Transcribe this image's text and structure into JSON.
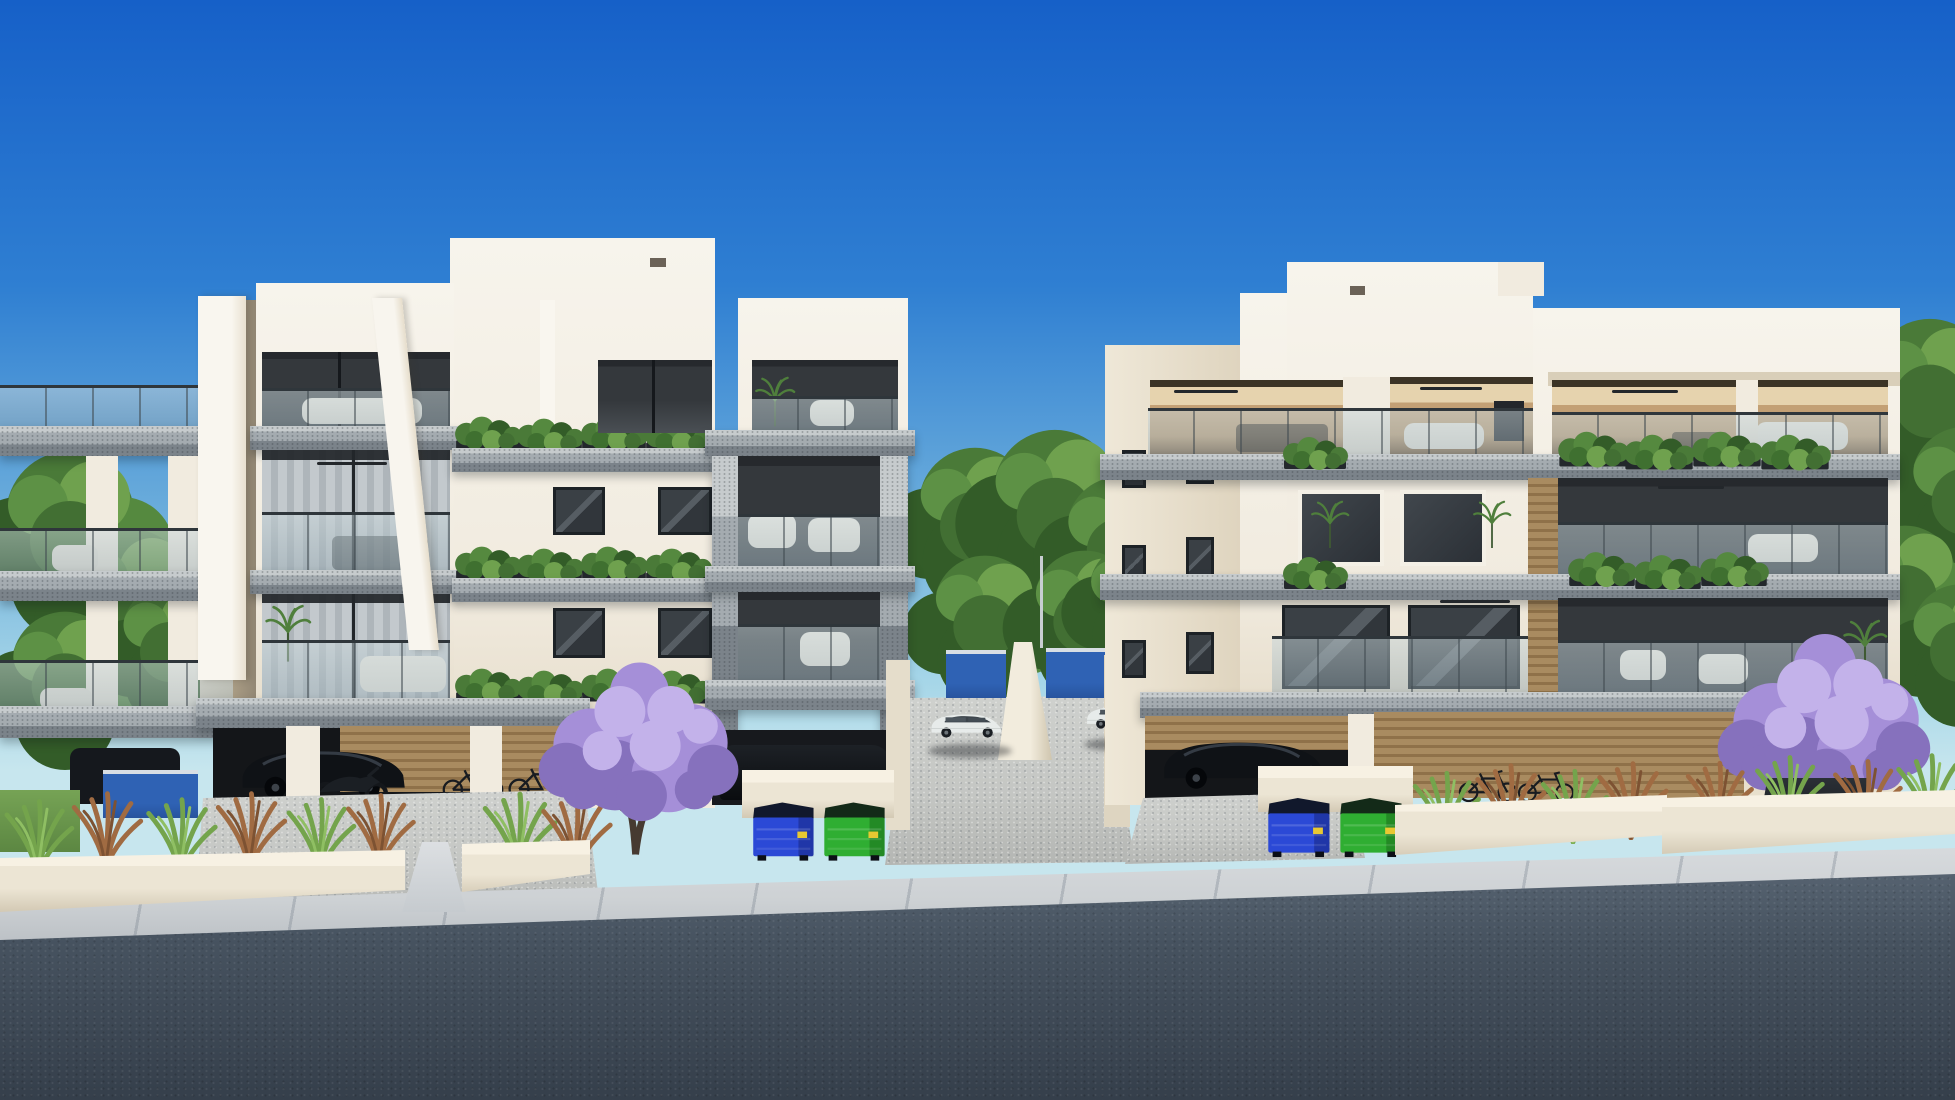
{
  "image": {
    "kind": "architectural-3d-render",
    "subject": "Street view of two modern three-storey apartment buildings with ground-level parking, landscaped planters, jacaranda trees and recycling bins under a clear blue sky",
    "width_px": 1955,
    "height_px": 1100,
    "visible_text": "none"
  },
  "scene": {
    "sky": {
      "description": "clear gradient sky, deep blue at top fading to pale cyan at horizon"
    },
    "buildings": [
      {
        "id": "left-building",
        "storeys": 3,
        "ground_level": "open pilotis parking",
        "features": [
          "stepped white parapet",
          "tall white vertical fins",
          "cantilevered terrazzo balcony slabs",
          "frameless glass railings",
          "floor-to-ceiling glazing with curtains",
          "trailing balcony planters",
          "gray terrazzo-framed corner balcony stack",
          "wood slat garage wall",
          "outdoor lounge furniture"
        ]
      },
      {
        "id": "right-building",
        "storeys": 3,
        "ground_level": "open pilotis parking",
        "features": [
          "stepped white parapet",
          "warm-lit interiors",
          "white-framed windows",
          "wood slat accent column and walls",
          "balcony planters with trailing greenery",
          "roof-level covered terrace",
          "glass railings",
          "ceiling fans"
        ]
      }
    ],
    "vehicles": [
      {
        "type": "suv",
        "color": "white",
        "location": "central driveway, left side"
      },
      {
        "type": "suv",
        "color": "white",
        "location": "central driveway, right side"
      },
      {
        "type": "suv",
        "color": "black",
        "location": "left building garage"
      },
      {
        "type": "suv",
        "color": "black",
        "location": "left building corner garage"
      },
      {
        "type": "suv",
        "color": "dark",
        "location": "right building garage"
      },
      {
        "type": "motorcycle",
        "location": "left building garage"
      },
      {
        "type": "motorcycle",
        "location": "right building garage"
      },
      {
        "type": "bicycles",
        "location": "against walls near both garages"
      }
    ],
    "vegetation": [
      {
        "type": "jacaranda-tree",
        "color": "purple",
        "location": "front of left building"
      },
      {
        "type": "jacaranda-tree",
        "color": "purple",
        "location": "front right, in dark planter box"
      },
      {
        "type": "ornamental-grasses",
        "colors": [
          "green",
          "rust"
        ],
        "location": "street planters along both buildings"
      },
      {
        "type": "background-trees",
        "location": "left edge, central gap, right edge"
      },
      {
        "type": "balcony-plants",
        "location": "balcony slabs and terraces of both buildings"
      },
      {
        "type": "lawn-patch",
        "location": "far left corner"
      }
    ],
    "sanitation": [
      {
        "bins": [
          "blue dumpster",
          "green dumpster"
        ],
        "location": "sidewalk in front of left building corner"
      },
      {
        "bins": [
          "blue dumpster",
          "green dumpster"
        ],
        "location": "sidewalk in front of right building"
      }
    ],
    "ground": {
      "elements": [
        "dark asphalt road across foreground",
        "light paved sidewalk with diagonal joints",
        "gravel driveways to each garage",
        "cream planter walls",
        "blue painted ramp walls between buildings",
        "white ramp divider wall",
        "thin light pole in central gap"
      ]
    }
  },
  "colors": {
    "sky-top": "#1660c8",
    "sky-mid": "#2f7fd2",
    "sky-low": "#6fb0dc",
    "sky-horizon": "#a6d6e8",
    "cream": "#f1ebdf",
    "cream-bright": "#f7f4ec",
    "cream-shade": "#ded3bf",
    "cream-dark": "#c9bda5",
    "slab-light": "#c6cbcd",
    "slab-mid": "#a4abb0",
    "slab-dark": "#7b838a",
    "frame": "#2f363b",
    "interior-warm-1": "#e6d3ae",
    "interior-warm-2": "#c3a075",
    "interior-warm-3": "#7d6144",
    "curtain-1": "#c3c9cd",
    "curtain-2": "#aeb5ba",
    "wood-1": "#a98b60",
    "wood-2": "#8f7149",
    "tree-1": "#4a7a38",
    "tree-2": "#335c28",
    "tree-3": "#6fa14e",
    "jac-1": "#a58fd8",
    "jac-2": "#c3b2ea",
    "jac-3": "#8671bd",
    "trunk": "#463a31",
    "grass-green": "#74a44c",
    "grass-green-light": "#8fbf63",
    "grass-rust": "#a06b42",
    "grass-rust-dark": "#7d5232",
    "planter": "#ece5d4",
    "planter-shade": "#d3c9b4",
    "sidewalk": "#cdd1d4",
    "asphalt-1": "#5d6a78",
    "asphalt-2": "#46525f",
    "asphalt-3": "#353f4b",
    "gravel": "#c4c6c3",
    "blue-wall": "#2f62b4",
    "bin-blue": "#2b49d6",
    "bin-green": "#2fae32",
    "bin-lid": "#11182c",
    "car-white": "#e7ebea",
    "car-dark": "#0f1216"
  }
}
